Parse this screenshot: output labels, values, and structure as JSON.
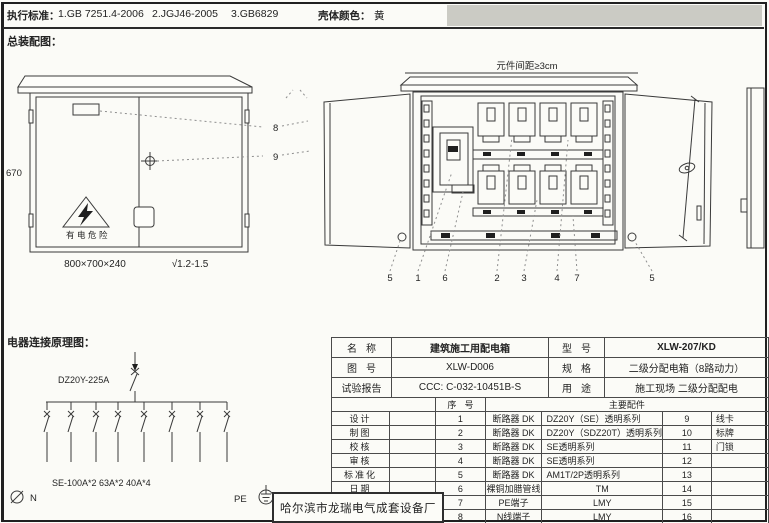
{
  "header": {
    "standards_label": "执行标准：",
    "standard_1": "1.GB 7251.4-2006",
    "standard_2": "2.JGJ46-2005",
    "standard_3": "3.GB6829",
    "shell_color_label": "壳体颜色：",
    "shell_color_value": "黄"
  },
  "sections": {
    "assembly_title": "总装配图：",
    "schematic_title": "电器连接原理图："
  },
  "assembly": {
    "front_view": {
      "height_dim": "670",
      "size_dim": "800×700×240",
      "plate_thickness": "√1.2-1.5",
      "warning_text": "有电危险",
      "callout_8": "8",
      "callout_9": "9"
    },
    "open_view": {
      "spacing_note": "元件间距≥3cm",
      "callouts": [
        "5",
        "1",
        "6",
        "2",
        "3",
        "4",
        "7",
        "5"
      ]
    }
  },
  "schematic": {
    "main_breaker_label": "DZ20Y-225A",
    "branch_spec_label": "SE-100A*2 63A*2 40A*4",
    "neutral_label": "N",
    "pe_label": "PE"
  },
  "title_block": {
    "name_label": "名称",
    "name_value": "建筑施工用配电箱",
    "model_label": "型号",
    "model_value": "XLW-207/KD",
    "drawing_no_label": "图号",
    "drawing_no_value": "XLW-D006",
    "spec_label": "规格",
    "spec_value": "二级分配电箱（8路动力）",
    "report_label": "试验报告",
    "report_value": "CCC: C-032-10451B-S",
    "usage_label": "用途",
    "usage_value": "施工现场 二级分配配电",
    "parts_header": {
      "seq": "序号",
      "main": "主要配件"
    },
    "sign_labels": [
      "设计",
      "制图",
      "校核",
      "审核",
      "标准化",
      "日期"
    ],
    "parts": [
      {
        "no": "1",
        "name": "断路器 DK",
        "spec": "DZ20Y（SE）透明系列",
        "no2": "9",
        "name2": "线卡"
      },
      {
        "no": "2",
        "name": "断路器 DK",
        "spec": "DZ20Y（SDZ20T）透明系列",
        "no2": "10",
        "name2": "标牌"
      },
      {
        "no": "3",
        "name": "断路器 DK",
        "spec": "SE透明系列",
        "no2": "11",
        "name2": "门锁"
      },
      {
        "no": "4",
        "name": "断路器 DK",
        "spec": "SE透明系列",
        "no2": "12",
        "name2": ""
      },
      {
        "no": "5",
        "name": "断路器 DK",
        "spec": "AM1T/2P透明系列",
        "no2": "13",
        "name2": ""
      },
      {
        "no": "6",
        "name": "裸铜加腊管线",
        "spec": "TM",
        "no2": "14",
        "name2": ""
      },
      {
        "no": "7",
        "name": "PE端子",
        "spec": "LMY",
        "no2": "15",
        "name2": ""
      },
      {
        "no": "8",
        "name": "N线端子",
        "spec": "LMY",
        "no2": "16",
        "name2": ""
      }
    ],
    "manufacturer": "哈尔滨市龙瑞电气成套设备厂"
  }
}
